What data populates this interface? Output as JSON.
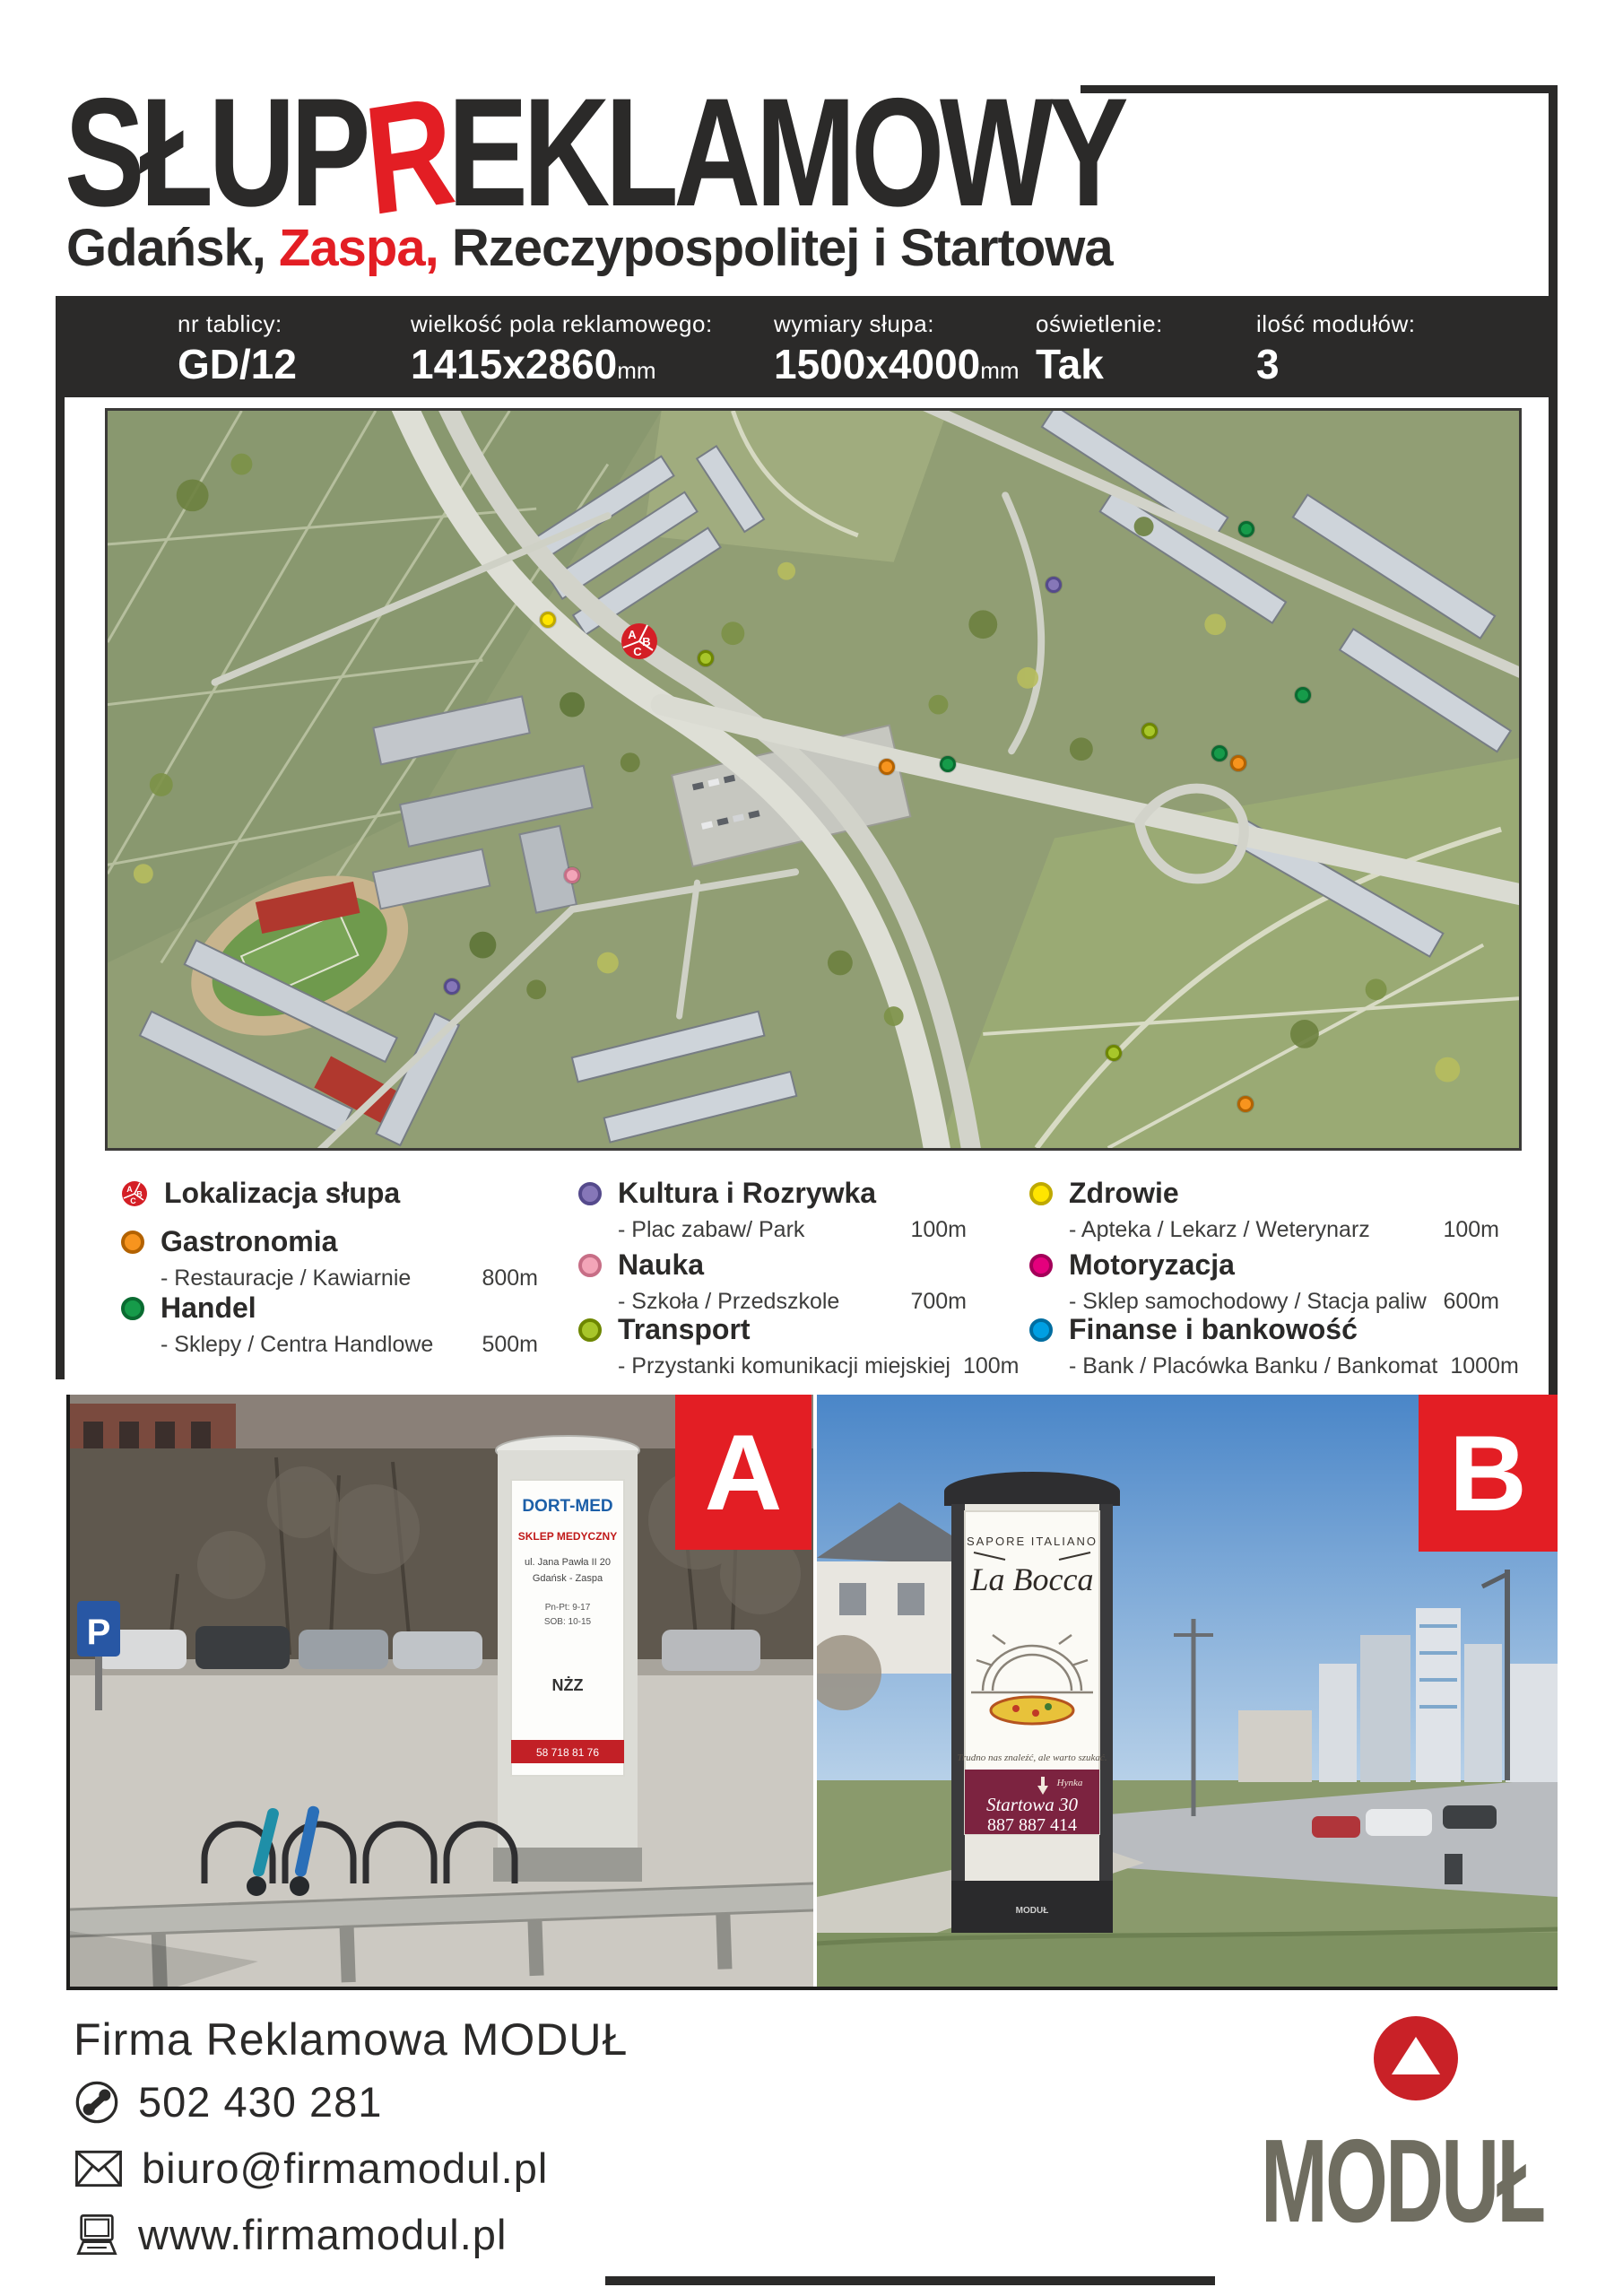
{
  "header": {
    "title_pre": "SŁUP",
    "title_r": "R",
    "title_post": "EKLAMOWY",
    "subtitle_city": "Gdańsk, ",
    "subtitle_district": "Zaspa,",
    "subtitle_street": " Rzeczypospolitej i Startowa"
  },
  "info_bar": {
    "items": [
      {
        "label": "nr tablicy:",
        "value": "GD/12",
        "unit": ""
      },
      {
        "label": "wielkość pola reklamowego:",
        "value": "1415x2860",
        "unit": "mm"
      },
      {
        "label": "wymiary słupa:",
        "value": "1500x4000",
        "unit": "mm"
      },
      {
        "label": "oświetlenie:",
        "value": "Tak",
        "unit": ""
      },
      {
        "label": "ilość modułów:",
        "value": "3",
        "unit": ""
      }
    ]
  },
  "map": {
    "marker": {
      "x": 37.7,
      "y": 31.3,
      "letters": [
        "A",
        "B",
        "C"
      ],
      "color": "#d41f26"
    },
    "poi": [
      {
        "color": "#ffe500",
        "border": "#bfa900",
        "x": 31.2,
        "y": 28.4
      },
      {
        "color": "#a8c62a",
        "border": "#6e8700",
        "x": 42.4,
        "y": 33.6
      },
      {
        "color": "#8677b8",
        "border": "#554a8c",
        "x": 67.0,
        "y": 23.6
      },
      {
        "color": "#169b4a",
        "border": "#0a6b31",
        "x": 80.7,
        "y": 16.1
      },
      {
        "color": "#f7941e",
        "border": "#b36200",
        "x": 55.2,
        "y": 48.3
      },
      {
        "color": "#169b4a",
        "border": "#0a6b31",
        "x": 59.5,
        "y": 47.9
      },
      {
        "color": "#a8c62a",
        "border": "#6e8700",
        "x": 73.8,
        "y": 43.4
      },
      {
        "color": "#169b4a",
        "border": "#0a6b31",
        "x": 84.7,
        "y": 38.6
      },
      {
        "color": "#169b4a",
        "border": "#0a6b31",
        "x": 78.8,
        "y": 46.5
      },
      {
        "color": "#f7941e",
        "border": "#b36200",
        "x": 80.1,
        "y": 47.8
      },
      {
        "color": "#f3a5b8",
        "border": "#c76e86",
        "x": 32.9,
        "y": 63.0
      },
      {
        "color": "#8677b8",
        "border": "#554a8c",
        "x": 24.4,
        "y": 78.1
      },
      {
        "color": "#a8c62a",
        "border": "#6e8700",
        "x": 71.3,
        "y": 87.1
      },
      {
        "color": "#f7941e",
        "border": "#b36200",
        "x": 80.6,
        "y": 94.0
      }
    ]
  },
  "legend": {
    "col1": [
      {
        "title": "Lokalizacja słupa"
      },
      {
        "dot_style": "background:#f7941e;border-color:#b36200",
        "title": "Gastronomia",
        "subtitle": "- Restauracje / Kawiarnie",
        "distance": "800m"
      },
      {
        "dot_style": "background:#169b4a;border-color:#0a6b31",
        "title": "Handel",
        "subtitle": "- Sklepy / Centra Handlowe",
        "distance": "500m"
      }
    ],
    "col2": [
      {
        "dot_style": "background:#8677b8;border-color:#554a8c",
        "title": "Kultura i Rozrywka",
        "subtitle": "- Plac zabaw/ Park",
        "distance": "100m"
      },
      {
        "dot_style": "background:#f3a5b8;border-color:#c76e86",
        "title": "Nauka",
        "subtitle": "- Szkoła / Przedszkole",
        "distance": "700m"
      },
      {
        "dot_style": "background:#a8c62a;border-color:#6e8700",
        "title": "Transport",
        "subtitle": "- Przystanki komunikacji miejskiej",
        "distance": "100m"
      }
    ],
    "col3": [
      {
        "dot_style": "background:#ffe500;border-color:#bfa900",
        "title": "Zdrowie",
        "subtitle": "- Apteka / Lekarz / Weterynarz",
        "distance": "100m"
      },
      {
        "dot_style": "background:#e5007d;border-color:#a30059",
        "title": "Motoryzacja",
        "subtitle": "- Sklep samochodowy / Stacja paliw",
        "distance": "600m"
      },
      {
        "dot_style": "background:#009fe3;border-color:#006da0",
        "title": "Finanse i bankowość",
        "subtitle": "- Bank / Placówka Banku / Bankomat",
        "distance": "1000m"
      }
    ]
  },
  "photos": {
    "badge_a": "A",
    "badge_b": "B",
    "a_sign": "P",
    "a_poster": {
      "brand": "DORT-MED",
      "heading": "SKLEP MEDYCZNY",
      "line1": "ul. Jana Pawła II 20",
      "line2": "Gdańsk - Zaspa",
      "hours1": "Pn-Pt: 9-17",
      "hours2": "SOB: 10-15",
      "logo": "NŻZ",
      "phone": "58 718 81 76"
    },
    "b_poster": {
      "top": "SAPORE ITALIANO",
      "brand": "La Bocca",
      "tagline": "Trudno nas znaleźć, ale warto szukać.",
      "street_sign": "Hynka",
      "address": "Startowa 30",
      "phone": "887 887 414",
      "column_brand": "MODUŁ"
    }
  },
  "footer": {
    "company": "Firma Reklamowa MODUŁ",
    "phone": "502 430 281",
    "email": "biuro@firmamodul.pl",
    "website": "www.firmamodul.pl",
    "logo_text": "MODUŁ"
  },
  "colors": {
    "accent": "#e31e24",
    "bar_bg": "#2b2a29",
    "logo_gray": "#6f6d60"
  }
}
